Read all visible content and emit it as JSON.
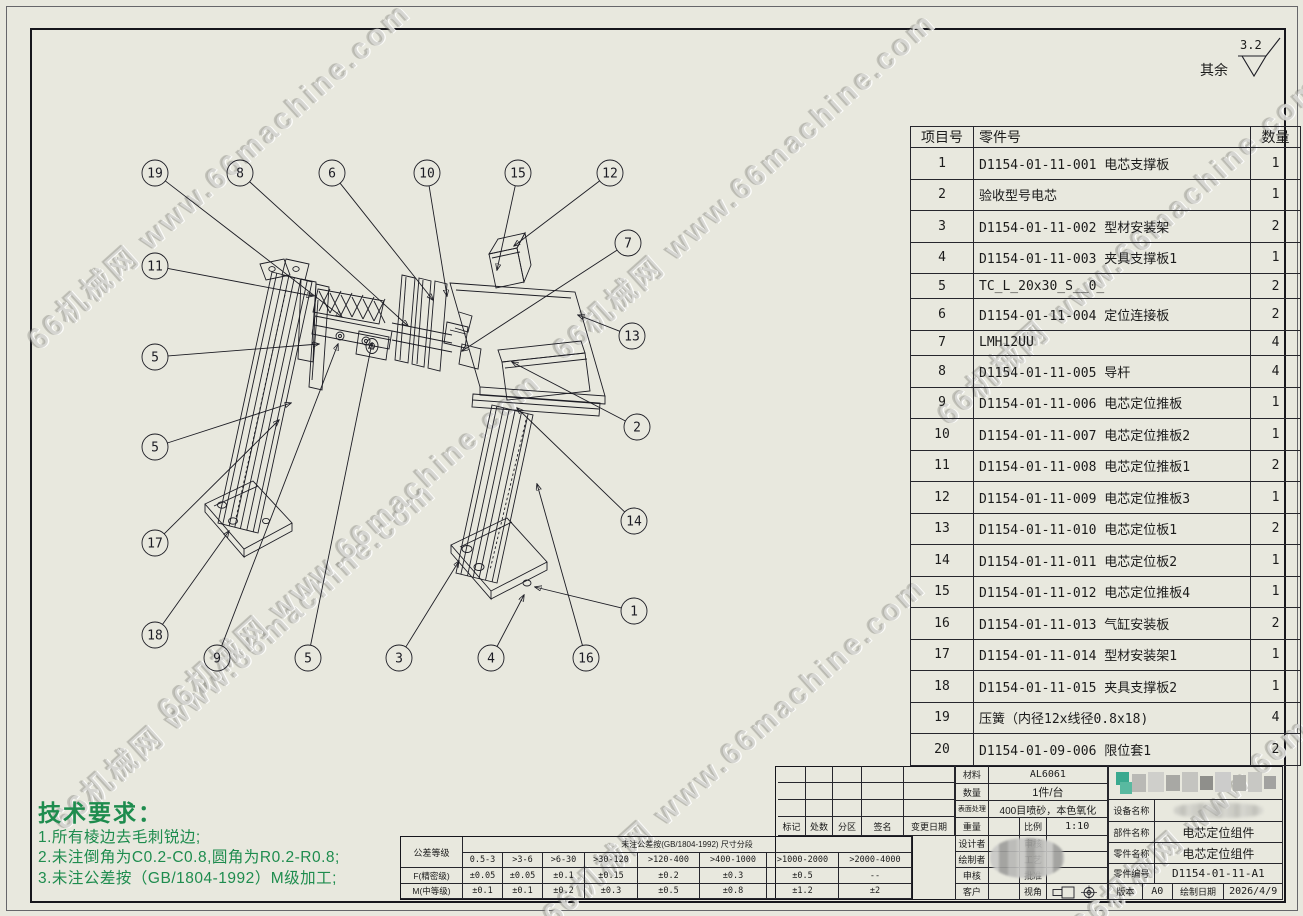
{
  "sheet": {
    "finish_note": {
      "label": "其余",
      "roughness": "3.2"
    },
    "watermark_text": "66机械网 www.66machine.com"
  },
  "watermarks": [
    {
      "left": 30,
      "top": 320
    },
    {
      "left": 55,
      "top": 800
    },
    {
      "left": 160,
      "top": 690
    },
    {
      "left": 555,
      "top": 330
    },
    {
      "left": 545,
      "top": 895
    },
    {
      "left": 940,
      "top": 395
    },
    {
      "left": 1075,
      "top": 905
    }
  ],
  "tech_requirements": {
    "title": "技术要求：",
    "items": [
      "1.所有棱边去毛刺锐边;",
      "2.未注倒角为C0.2-C0.8,圆角为R0.2-R0.8;",
      "3.未注公差按（GB/1804-1992）M级加工;"
    ]
  },
  "parts_table": {
    "headers": [
      "项目号",
      "零件号",
      "数量"
    ],
    "rows": [
      [
        "1",
        "D1154-01-11-001 电芯支撑板",
        "1"
      ],
      [
        "2",
        "验收型号电芯",
        "1"
      ],
      [
        "3",
        "D1154-01-11-002 型材安装架",
        "2"
      ],
      [
        "4",
        "D1154-01-11-003 夹具支撑板1",
        "1"
      ],
      [
        "5",
        "TC_L_20x30_S__0_",
        "2"
      ],
      [
        "6",
        "D1154-01-11-004 定位连接板",
        "2"
      ],
      [
        "7",
        "LMH12UU",
        "4"
      ],
      [
        "8",
        "D1154-01-11-005 导杆",
        "4"
      ],
      [
        "9",
        "D1154-01-11-006 电芯定位推板",
        "1"
      ],
      [
        "10",
        "D1154-01-11-007 电芯定位推板2",
        "1"
      ],
      [
        "11",
        "D1154-01-11-008 电芯定位推板1",
        "2"
      ],
      [
        "12",
        "D1154-01-11-009 电芯定位推板3",
        "1"
      ],
      [
        "13",
        "D1154-01-11-010 电芯定位板1",
        "2"
      ],
      [
        "14",
        "D1154-01-11-011 电芯定位板2",
        "1"
      ],
      [
        "15",
        "D1154-01-11-012 电芯定位推板4",
        "1"
      ],
      [
        "16",
        "D1154-01-11-013 气缸安装板",
        "2"
      ],
      [
        "17",
        "D1154-01-11-014 型材安装架1",
        "1"
      ],
      [
        "18",
        "D1154-01-11-015 夹具支撑板2",
        "1"
      ],
      [
        "19",
        "压簧（内径12x线径0.8x18)",
        "4"
      ],
      [
        "20",
        "D1154-01-09-006 限位套1",
        "2"
      ]
    ]
  },
  "balloons": [
    {
      "n": "19",
      "x": 155,
      "y": 173,
      "tx": 342,
      "ty": 317
    },
    {
      "n": "8",
      "x": 240,
      "y": 173,
      "tx": 408,
      "ty": 326
    },
    {
      "n": "6",
      "x": 332,
      "y": 173,
      "tx": 433,
      "ty": 300
    },
    {
      "n": "10",
      "x": 427,
      "y": 173,
      "tx": 447,
      "ty": 296
    },
    {
      "n": "15",
      "x": 518,
      "y": 173,
      "tx": 497,
      "ty": 270
    },
    {
      "n": "12",
      "x": 610,
      "y": 173,
      "tx": 514,
      "ty": 246
    },
    {
      "n": "7",
      "x": 628,
      "y": 243,
      "tx": 462,
      "ty": 351
    },
    {
      "n": "11",
      "x": 155,
      "y": 266,
      "tx": 313,
      "ty": 296
    },
    {
      "n": "13",
      "x": 632,
      "y": 336,
      "tx": 578,
      "ty": 315
    },
    {
      "n": "5",
      "x": 155,
      "y": 357,
      "tx": 319,
      "ty": 344
    },
    {
      "n": "2",
      "x": 637,
      "y": 427,
      "tx": 512,
      "ty": 362
    },
    {
      "n": "5",
      "x": 155,
      "y": 447,
      "tx": 291,
      "ty": 403
    },
    {
      "n": "14",
      "x": 634,
      "y": 521,
      "tx": 517,
      "ty": 408
    },
    {
      "n": "17",
      "x": 155,
      "y": 543,
      "tx": 279,
      "ty": 420
    },
    {
      "n": "1",
      "x": 634,
      "y": 611,
      "tx": 535,
      "ty": 587
    },
    {
      "n": "18",
      "x": 155,
      "y": 635,
      "tx": 229,
      "ty": 531
    },
    {
      "n": "9",
      "x": 217,
      "y": 658,
      "tx": 338,
      "ty": 344
    },
    {
      "n": "5",
      "x": 308,
      "y": 658,
      "tx": 372,
      "ty": 343
    },
    {
      "n": "3",
      "x": 399,
      "y": 658,
      "tx": 459,
      "ty": 561
    },
    {
      "n": "4",
      "x": 491,
      "y": 658,
      "tx": 524,
      "ty": 595
    },
    {
      "n": "16",
      "x": 586,
      "y": 658,
      "tx": 537,
      "ty": 484
    }
  ],
  "tolerance_table": {
    "corner_label": "公差等级",
    "title": "未注公差按(GB/1804-1992)  尺寸分段",
    "ranges": [
      "0.5-3",
      ">3-6",
      ">6-30",
      ">30-120",
      ">120-400",
      ">400-1000",
      ">1000-2000",
      ">2000-4000"
    ],
    "rows": [
      {
        "grade": "F(精密级)",
        "values": [
          "±0.05",
          "±0.05",
          "±0.1",
          "±0.15",
          "±0.2",
          "±0.3",
          "±0.5",
          "--"
        ]
      },
      {
        "grade": "M(中等级)",
        "values": [
          "±0.1",
          "±0.1",
          "±0.2",
          "±0.3",
          "±0.5",
          "±0.8",
          "±1.2",
          "±2"
        ]
      }
    ]
  },
  "revision_block": {
    "headers": [
      "标记",
      "处数",
      "分区",
      "签名",
      "变更日期"
    ]
  },
  "title_block": {
    "material_label": "材料",
    "material_value": "AL6061",
    "quantity_label": "数量",
    "quantity_value": "1件/台",
    "surface_label": "表面处理",
    "surface_value": "400目喷砂，本色氧化",
    "weight_label": "重量",
    "scale_label": "比例",
    "scale_value": "1:10",
    "designer_label": "设计者",
    "review_label": "审核",
    "drafter_label": "绘制者",
    "process_label": "工艺",
    "check_label": "申核",
    "approve_label": "批准",
    "customer_label": "客户",
    "view_label": "视角",
    "device_label": "设备名称",
    "assembly_label": "部件名称",
    "assembly_value": "电芯定位组件",
    "part_label": "零件名称",
    "part_value": "电芯定位组件",
    "partno_label": "零件编号",
    "partno_value": "D1154-01-11-A1",
    "version_label": "版本",
    "version_value": "A0",
    "date_label": "绘制日期",
    "date_value": "2026/4/9"
  }
}
